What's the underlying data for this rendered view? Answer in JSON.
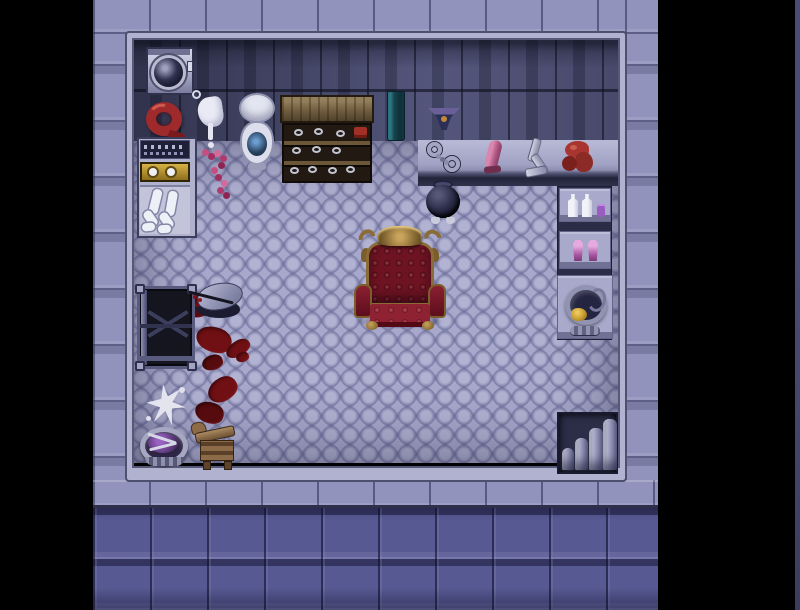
{
  "meta": {
    "scene_title": "Top-down RPG room — throne chamber",
    "viewport": {
      "width": 800,
      "height": 610
    }
  },
  "palette": {
    "background": "#000000",
    "outer_wall": "#9193bc",
    "inner_wall": "#5a5c84",
    "floor": "#a2a3cc",
    "frame": "#b1b2cf",
    "bottom_wall": "#575992",
    "blood": "#701014",
    "throne_red": "#6d1322",
    "throne_gold": "#8a6c36",
    "milk_white": "#e9eaf4",
    "bead_pink": "#c64f82"
  },
  "scene": {
    "rects": {
      "wall-top": {
        "x": 93,
        "y": 0,
        "w": 565,
        "h": 34,
        "label": "outer wall top band"
      },
      "wall-left": {
        "x": 93,
        "y": 0,
        "w": 34,
        "h": 480,
        "label": "outer wall left column"
      },
      "wall-right": {
        "x": 625,
        "y": 0,
        "w": 33,
        "h": 480,
        "label": "outer wall right column"
      },
      "ledge": {
        "x": 93,
        "y": 480,
        "w": 565,
        "h": 28,
        "label": "bottom ledge row"
      },
      "bottom-wall": {
        "x": 93,
        "y": 508,
        "w": 565,
        "h": 102,
        "label": "bottom outer wall"
      },
      "wall-dark": {
        "x": 132,
        "y": 38,
        "w": 486,
        "h": 103,
        "label": "interior grimy wall"
      },
      "floor": {
        "x": 132,
        "y": 141,
        "w": 486,
        "h": 322,
        "label": "cobblestone floor"
      },
      "shelf-band": {
        "x": 418,
        "y": 140,
        "w": 200,
        "h": 46,
        "label": "long wall shelf"
      },
      "room-frame": {
        "x": 127,
        "y": 33,
        "w": 498,
        "h": 447,
        "label": "room border frame"
      },
      "blood-pool": {
        "x": 185,
        "y": 295,
        "w": 28,
        "h": 22,
        "label": "blood pool"
      },
      "blood-1": {
        "x": 196,
        "y": 327,
        "w": 36,
        "h": 25,
        "label": "blood stain"
      },
      "blood-2": {
        "x": 225,
        "y": 341,
        "w": 26,
        "h": 15,
        "label": "blood stain"
      },
      "blood-3": {
        "x": 202,
        "y": 355,
        "w": 21,
        "h": 15,
        "label": "blood stain"
      },
      "blood-4": {
        "x": 207,
        "y": 378,
        "w": 31,
        "h": 23,
        "label": "blood stain"
      },
      "blood-5": {
        "x": 195,
        "y": 402,
        "w": 29,
        "h": 21,
        "label": "blood stain"
      },
      "blood-6": {
        "x": 236,
        "y": 352,
        "w": 13,
        "h": 10,
        "label": "blood drop"
      },
      "washing-machine": {
        "x": 146,
        "y": 47,
        "w": 48,
        "h": 48,
        "label": "washing machine"
      },
      "red-whip": {
        "x": 142,
        "y": 99,
        "w": 46,
        "h": 45,
        "label": "coiled red whip"
      },
      "milk-splash": {
        "x": 191,
        "y": 90,
        "w": 38,
        "h": 58,
        "label": "white splash dripping on wall"
      },
      "toilet": {
        "x": 236,
        "y": 93,
        "w": 42,
        "h": 78,
        "label": "toilet"
      },
      "vanity": {
        "x": 137,
        "y": 137,
        "w": 60,
        "h": 101,
        "label": "vanity cabinet with stockings"
      },
      "beads": {
        "x": 198,
        "y": 147,
        "w": 38,
        "h": 52,
        "label": "scattered pink beads"
      },
      "dresser": {
        "x": 280,
        "y": 95,
        "w": 94,
        "h": 90,
        "label": "wooden display shelf"
      },
      "teal-door": {
        "x": 387,
        "y": 91,
        "w": 18,
        "h": 50,
        "label": "tall dark panel"
      },
      "panties": {
        "x": 428,
        "y": 104,
        "w": 32,
        "h": 28,
        "label": "panties on wall"
      },
      "handcuffs": {
        "x": 426,
        "y": 141,
        "w": 36,
        "h": 34,
        "label": "handcuffs on shelf"
      },
      "dildo": {
        "x": 481,
        "y": 139,
        "w": 23,
        "h": 34,
        "label": "pink toy on shelf"
      },
      "harness": {
        "x": 522,
        "y": 137,
        "w": 30,
        "h": 43,
        "label": "leather straps on shelf"
      },
      "red-gag": {
        "x": 560,
        "y": 138,
        "w": 36,
        "h": 39,
        "label": "red rope bundle on shelf"
      },
      "cauldron": {
        "x": 424,
        "y": 180,
        "w": 38,
        "h": 45,
        "label": "iron pot"
      },
      "shelf-column": {
        "x": 557,
        "y": 186,
        "w": 55,
        "h": 154,
        "label": "right shelf column"
      },
      "bottles-shelf": {
        "x": 559,
        "y": 188,
        "w": 52,
        "h": 34,
        "label": "shelf with bottles"
      },
      "shoes-shelf": {
        "x": 559,
        "y": 231,
        "w": 52,
        "h": 38,
        "label": "shelf with shoes"
      },
      "bucket-shelf": {
        "x": 557,
        "y": 275,
        "w": 56,
        "h": 64,
        "label": "shelf with bucket and rope"
      },
      "throne": {
        "x": 352,
        "y": 226,
        "w": 96,
        "h": 105,
        "label": "red and gold throne"
      },
      "bed": {
        "x": 137,
        "y": 286,
        "w": 58,
        "h": 83,
        "label": "metal frame bed"
      },
      "bench": {
        "x": 188,
        "y": 280,
        "w": 62,
        "h": 42,
        "label": "overturned stool"
      },
      "white-splat": {
        "x": 145,
        "y": 382,
        "w": 43,
        "h": 47,
        "label": "white splatter on floor"
      },
      "basin": {
        "x": 139,
        "y": 421,
        "w": 52,
        "h": 47,
        "label": "wash basin with purple contents"
      },
      "wooden-horse": {
        "x": 188,
        "y": 417,
        "w": 54,
        "h": 53,
        "label": "wooden horse"
      },
      "stairs": {
        "x": 557,
        "y": 412,
        "w": 61,
        "h": 62,
        "label": "stone stairs"
      },
      "right-edge-strip": {
        "x": 795,
        "y": 0,
        "w": 5,
        "h": 610,
        "label": "screen edge sliver"
      }
    }
  }
}
